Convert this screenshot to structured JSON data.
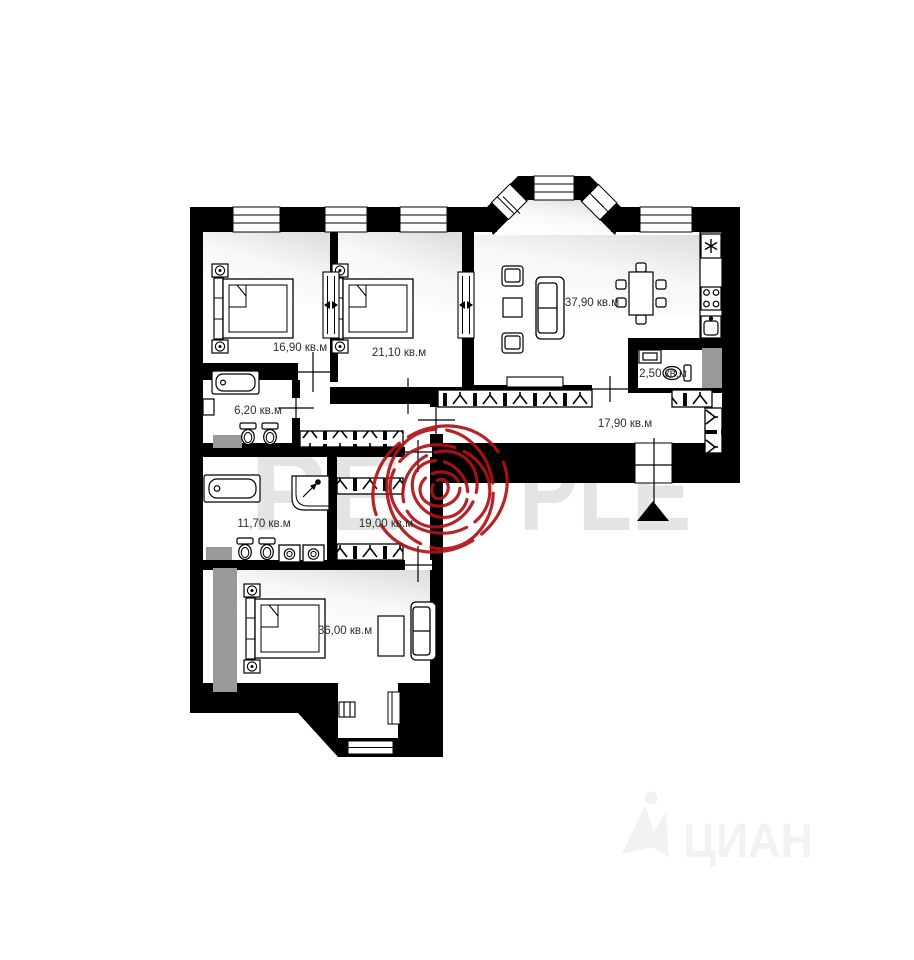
{
  "floor_plan": {
    "title": "apartment-floor-plan",
    "unit_suffix": "кв.м",
    "rooms": [
      {
        "name": "bedroom-1",
        "area": "16,90 кв.м"
      },
      {
        "name": "bedroom-2",
        "area": "21,10 кв.м"
      },
      {
        "name": "living-kitchen",
        "area": "37,90 кв.м"
      },
      {
        "name": "wc",
        "area": "2,50 кв.м"
      },
      {
        "name": "bathroom-1",
        "area": "6,20 кв.м"
      },
      {
        "name": "corridor",
        "area": "17,90 кв.м"
      },
      {
        "name": "bathroom-2",
        "area": "11,70 кв.м"
      },
      {
        "name": "hallway",
        "area": "19,00 кв.м"
      },
      {
        "name": "bedroom-3",
        "area": "36,00 кв.м"
      }
    ],
    "watermark": {
      "full": "PEOPLE",
      "left_part": "PE",
      "right_part": "PLE",
      "letters_color": "#e4e4e4",
      "fingerprint_color": "#b01217"
    },
    "agency_watermark": {
      "text": "ЦИАН",
      "color": "#f2f2f2"
    },
    "colors": {
      "walls": "#000000",
      "shaft": "#999999",
      "background": "#ffffff"
    }
  }
}
